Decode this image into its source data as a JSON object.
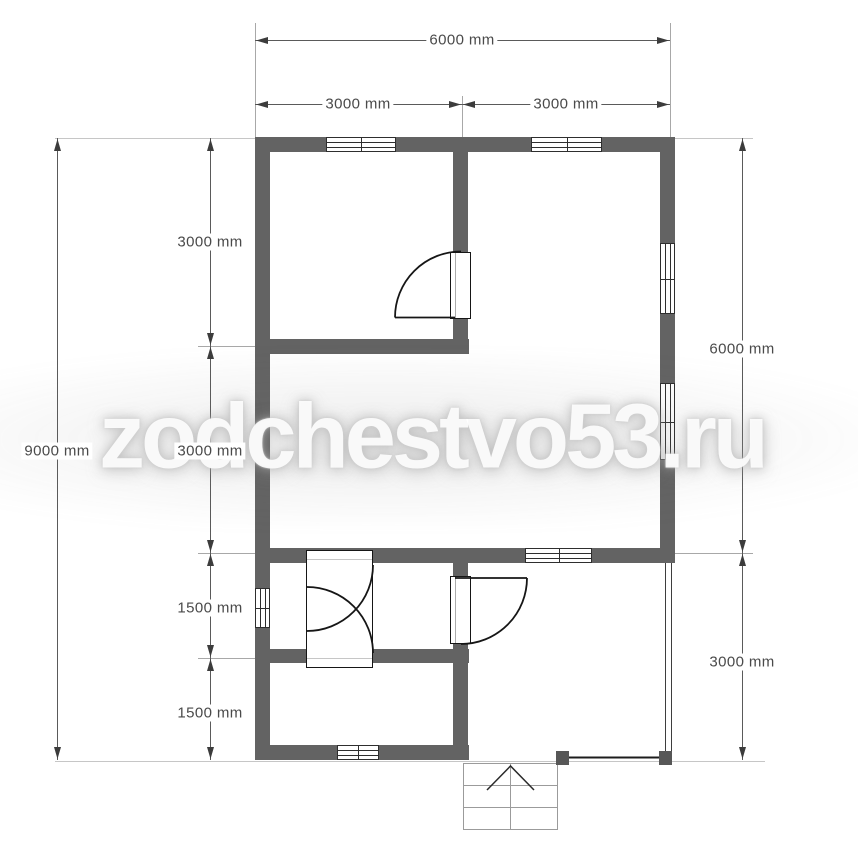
{
  "watermark": {
    "text": "zodchestvo53.ru"
  },
  "units": "mm",
  "dimensions": {
    "top": {
      "total": "6000 mm",
      "segments": [
        "3000 mm",
        "3000 mm"
      ]
    },
    "left": {
      "total": "9000 mm",
      "segments": [
        "3000 mm",
        "3000 mm",
        "1500 mm",
        "1500 mm"
      ]
    },
    "right": {
      "segments": [
        "6000 mm",
        "3000 mm"
      ]
    }
  },
  "plan": {
    "type": "floor-plan",
    "wall_color": "#636363",
    "window_count": 7,
    "door_count": 4,
    "stair_steps": 3
  }
}
